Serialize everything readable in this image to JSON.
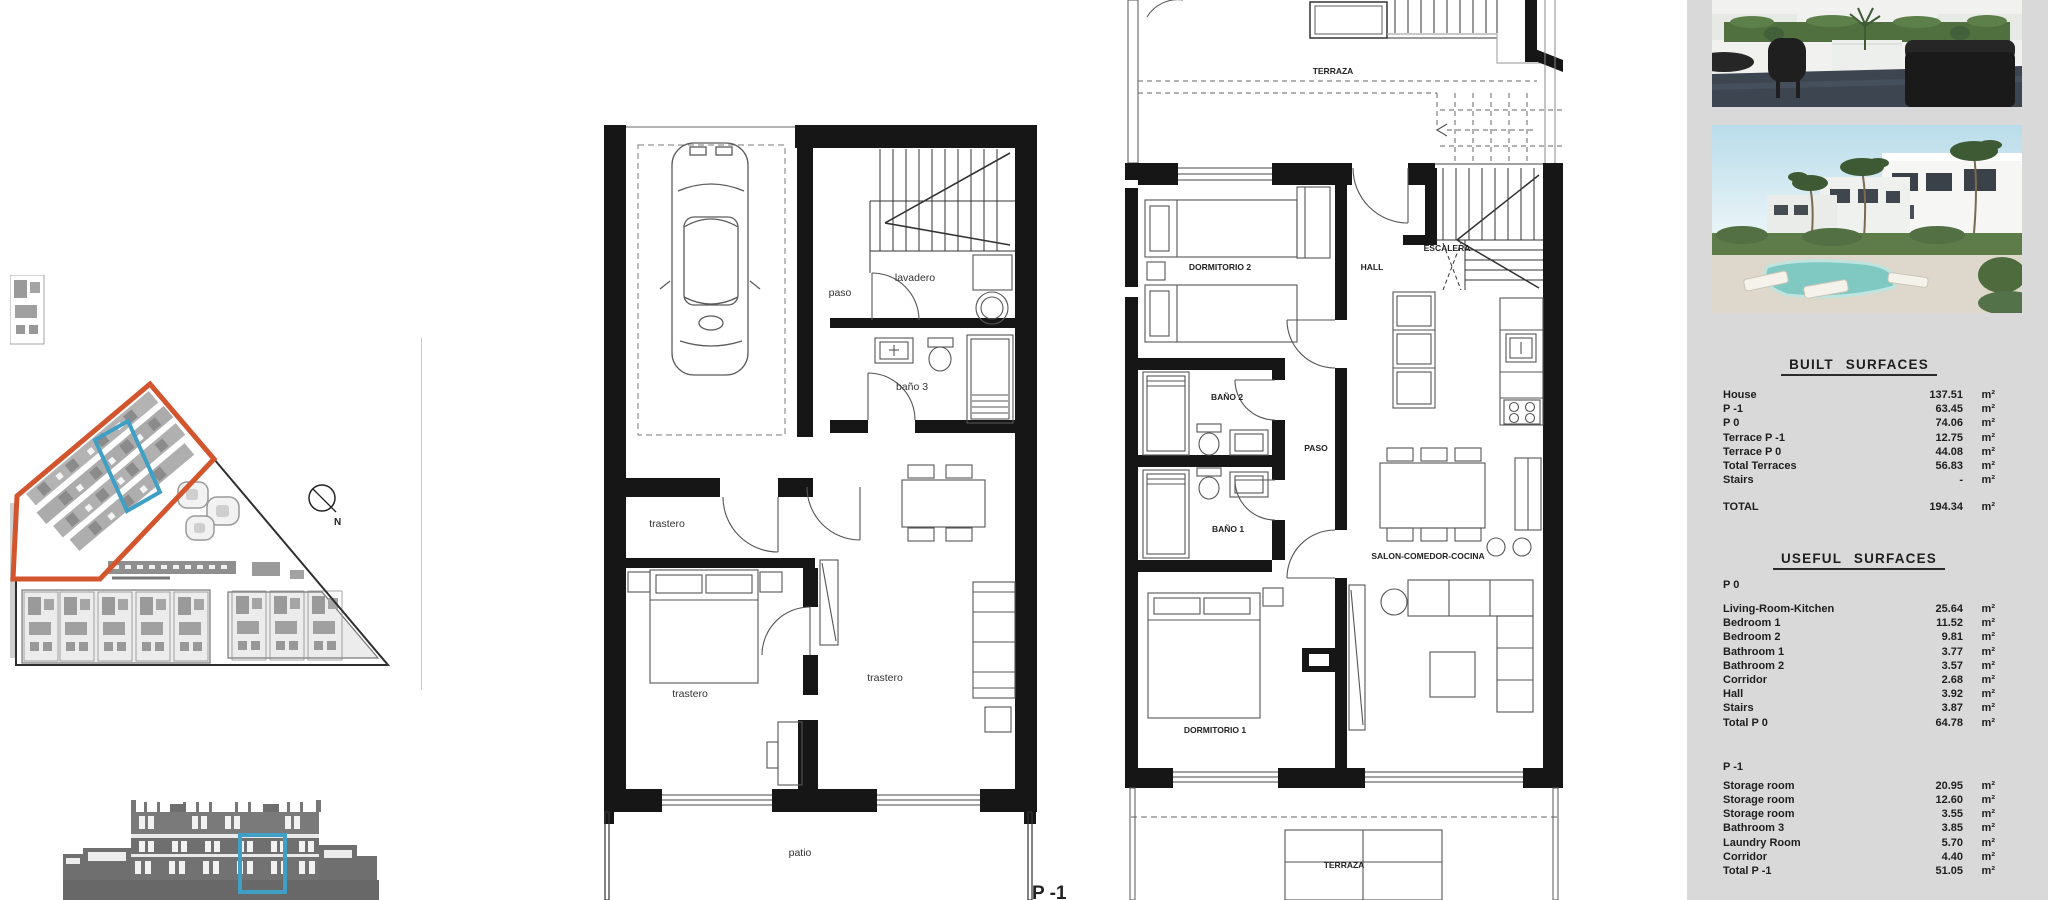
{
  "plan_p1": {
    "floor_tag": "P -1",
    "rooms": {
      "paso": "paso",
      "lavadero": "lavadero",
      "bano3": "baño 3",
      "trastero_top": "trastero",
      "trastero_mid": "trastero",
      "trastero_main": "trastero",
      "patio": "patio"
    }
  },
  "plan_p0": {
    "rooms": {
      "terraza_top": "TERRAZA",
      "dormitorio2": "DORMITORIO 2",
      "hall": "HALL",
      "escalera": "ESCALERA",
      "bano2": "BAÑO 2",
      "paso": "PASO",
      "bano1": "BAÑO 1",
      "salon": "SALON-COMEDOR-COCINA",
      "dormitorio1": "DORMITORIO 1",
      "terraza_bottom": "TERRAZA"
    }
  },
  "site_plan": {
    "north_label": "N"
  },
  "sidebar": {
    "unit": "m²",
    "built": {
      "title": "BUILT SURFACES",
      "rows": [
        {
          "label": "House",
          "value": "137.51"
        },
        {
          "label": "P -1",
          "value": "63.45"
        },
        {
          "label": "P 0",
          "value": "74.06"
        },
        {
          "label": "Terrace P -1",
          "value": "12.75"
        },
        {
          "label": "Terrace P 0",
          "value": "44.08"
        },
        {
          "label": "Total Terraces",
          "value": "56.83"
        },
        {
          "label": "Stairs",
          "value": "-"
        }
      ],
      "total": {
        "label": "TOTAL",
        "value": "194.34"
      }
    },
    "useful": {
      "title": "USEFUL SURFACES",
      "p0_heading": "P 0",
      "p0_rows": [
        {
          "label": "Living-Room-Kitchen",
          "value": "25.64"
        },
        {
          "label": "Bedroom 1",
          "value": "11.52"
        },
        {
          "label": "Bedroom 2",
          "value": "9.81"
        },
        {
          "label": "Bathroom 1",
          "value": "3.77"
        },
        {
          "label": "Bathroom 2",
          "value": "3.57"
        },
        {
          "label": "Corridor",
          "value": "2.68"
        },
        {
          "label": "Hall",
          "value": "3.92"
        },
        {
          "label": "Stairs",
          "value": "3.87"
        }
      ],
      "p0_total": {
        "label": "Total P 0",
        "value": "64.78"
      },
      "p1_heading": "P -1",
      "p1_rows": [
        {
          "label": "Storage room",
          "value": "20.95"
        },
        {
          "label": "Storage room",
          "value": "12.60"
        },
        {
          "label": "Storage room",
          "value": "3.55"
        },
        {
          "label": "Bathroom 3",
          "value": "3.85"
        },
        {
          "label": "Laundry Room",
          "value": "5.70"
        },
        {
          "label": "Corridor",
          "value": "4.40"
        }
      ],
      "p1_total": {
        "label": "Total P -1",
        "value": "51.05"
      }
    }
  },
  "colors": {
    "accent_orange": "#d2552e",
    "accent_blue": "#3f9fc4",
    "sidebar_bg": "#d9d9d9",
    "wall_black": "#161616",
    "site_gray": "#9a9a9a",
    "elevation_gray": "#6f6f6f"
  }
}
